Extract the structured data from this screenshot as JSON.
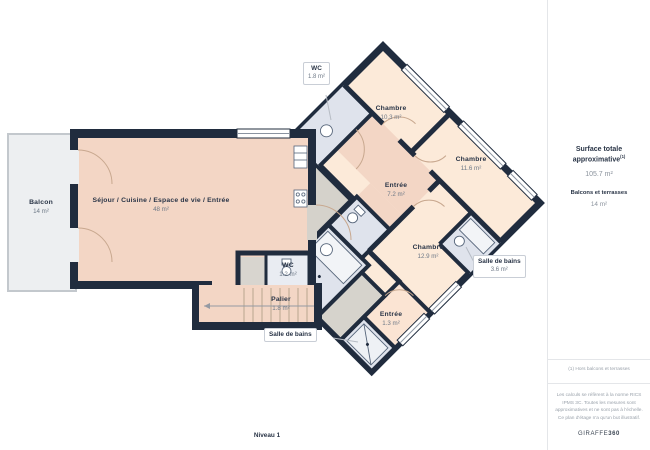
{
  "plan": {
    "level_label": "Niveau 1",
    "rooms": {
      "balcon": {
        "name": "Balcon",
        "area": "14 m²"
      },
      "sejour": {
        "name": "Séjour / Cuisine / Espace de vie / Entrée",
        "area": "48 m²"
      },
      "wc_haut": {
        "name": "WC",
        "area": "1.8 m²"
      },
      "chambre_1": {
        "name": "Chambre",
        "area": "10.3 m²"
      },
      "chambre_2": {
        "name": "Chambre",
        "area": "11.6 m²"
      },
      "entree": {
        "name": "Entrée",
        "area": "7.2 m²"
      },
      "chambre_3": {
        "name": "Chambre",
        "area": "12.9 m²"
      },
      "salle_de_bains_droite": {
        "name": "Salle de bains",
        "area": "3.6 m²"
      },
      "wc_bas": {
        "name": "WC",
        "area": "1.2 m²"
      },
      "palier": {
        "name": "Palier",
        "area": "1.8 m²"
      },
      "entree_petite": {
        "name": "Entrée",
        "area": "1.3 m²"
      },
      "salle_de_bains_bas": {
        "name": "Salle de bains"
      }
    },
    "colors": {
      "wall": "#202c3e",
      "living": "#f3d6c5",
      "bedroom": "#fcead9",
      "wet_room": "#dfe3ec",
      "utility": "#d6d3cc",
      "balcony": "#edeff1"
    }
  },
  "sidebar": {
    "surface_title": "Surface totale approximative",
    "surface_footnote_marker": "(1)",
    "surface_value": "105.7 m²",
    "terraces_title": "Balcons et terrasses",
    "terraces_value": "14 m²",
    "footnote": "(1) Hors balcons et terrasses",
    "disclaimer": "Les calculs se réfèrent à la norme RICS IPMS 3C. Toutes les mesures sont approximatives et ne sont pas à l'échelle. Ce plan d'étage n'a qu'un but illustratif.",
    "brand_name": "GIRAFFE",
    "brand_suffix": "360"
  }
}
